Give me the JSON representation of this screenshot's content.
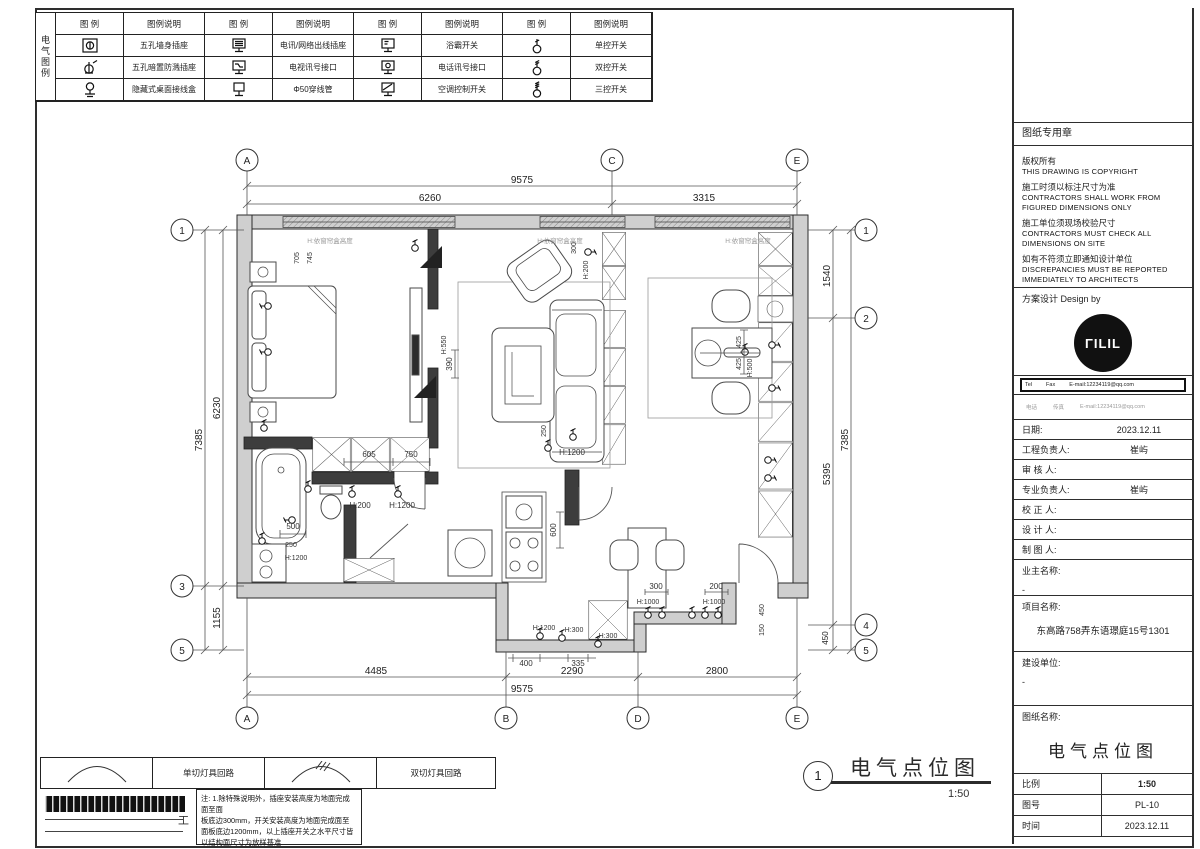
{
  "legend": {
    "side_label": "电气图例",
    "header_icon": "图 例",
    "header_desc": "图例说明",
    "groups": [
      {
        "rows": [
          {
            "icon": "five-hole-wall-socket-icon",
            "label": "五孔墙身插座"
          },
          {
            "icon": "five-hole-splash-proof-socket-icon",
            "label": "五孔暗置防溅插座"
          },
          {
            "icon": "concealed-desktop-junction-box-icon",
            "label": "隐藏式桌面接线盒"
          }
        ]
      },
      {
        "rows": [
          {
            "icon": "telecom-network-outlet-icon",
            "label": "电讯/网络出线插座"
          },
          {
            "icon": "tv-signal-outlet-icon",
            "label": "电视讯号接口"
          },
          {
            "icon": "conduit-icon",
            "label": "Φ50穿线管"
          }
        ]
      },
      {
        "rows": [
          {
            "icon": "bath-heater-switch-icon",
            "label": "浴霸开关"
          },
          {
            "icon": "phone-signal-outlet-icon",
            "label": "电话讯号接口"
          },
          {
            "icon": "ac-control-switch-icon",
            "label": "空调控制开关"
          }
        ]
      },
      {
        "rows": [
          {
            "icon": "single-switch-icon",
            "label": "单控开关"
          },
          {
            "icon": "double-switch-icon",
            "label": "双控开关"
          },
          {
            "icon": "triple-switch-icon",
            "label": "三控开关"
          }
        ]
      }
    ]
  },
  "titleblock": {
    "stamp_title": "图纸专用章",
    "copyright_lines": [
      {
        "t": "版权所有"
      },
      {
        "t": "THIS DRAWING IS COPYRIGHT"
      },
      {
        "t": "施工时须以标注尺寸为准"
      },
      {
        "t": "CONTRACTORS SHALL WORK FROM"
      },
      {
        "t": "FIGURED DIMENSIONS ONLY"
      },
      {
        "t": "施工单位须现场校验尺寸"
      },
      {
        "t": "CONTRACTORS MUST CHECK ALL"
      },
      {
        "t": "DIMENSIONS ON SITE"
      },
      {
        "t": "如有不符须立即通知设计单位"
      },
      {
        "t": "DISCREPANCIES MUST BE REPORTED"
      },
      {
        "t": "IMMEDIATELY TO ARCHITECTS"
      }
    ],
    "design_by": "方案设计 Design by",
    "logo_text": "ΓILIL",
    "contact": {
      "tel": "Tel",
      "fax": "Fax",
      "email": "E-mail:12234119@qq.com"
    },
    "contact2": {
      "tel": "电话",
      "fax": "传真",
      "email": "E-mail:12234119@qq.com"
    },
    "fields": [
      {
        "label": "日期:",
        "value": "2023.12.11"
      },
      {
        "label": "工程负责人:",
        "value": "崔屿"
      },
      {
        "label": "审 核 人:",
        "value": ""
      },
      {
        "label": "专业负责人:",
        "value": "崔屿"
      },
      {
        "label": "校 正 人:",
        "value": ""
      },
      {
        "label": "设 计 人:",
        "value": ""
      },
      {
        "label": "制 图 人:",
        "value": ""
      }
    ],
    "owner": {
      "label": "业主名称:",
      "value": "-"
    },
    "project": {
      "label": "项目名称:",
      "value": "东高路758弄东语璟庭15号1301"
    },
    "builder": {
      "label": "建设单位:",
      "value": "-"
    },
    "sheet_name": {
      "label": "图纸名称:",
      "value": "电气点位图"
    },
    "meta": [
      {
        "label": "比例",
        "value": "1:50"
      },
      {
        "label": "图号",
        "value": "PL-10"
      },
      {
        "label": "时间",
        "value": "2023.12.11"
      }
    ]
  },
  "footer": {
    "circuit_legend": [
      {
        "icon": "single-circuit-arc-icon",
        "label": "单切灯具回路"
      },
      {
        "icon": "double-circuit-arc-icon",
        "label": "双切灯具回路"
      }
    ],
    "end_mark": "工",
    "note_lines": [
      "注: 1.除特殊说明外，插座安装高度为地面完成面至面",
      "板底边300mm，开关安装高度为地面完成面至",
      "面板底边1200mm，以上插座开关之水平尺寸皆",
      "以结构面尺寸为放样基准"
    ]
  },
  "title": {
    "number": "1",
    "name": "电气点位图",
    "scale": "1:50"
  },
  "plan": {
    "axes_top": [
      "A",
      "C",
      "E"
    ],
    "axes_bottom": [
      "A",
      "B",
      "D",
      "E"
    ],
    "axes_left": [
      "1",
      "3",
      "5"
    ],
    "axes_right": [
      "1",
      "2",
      "4",
      "5"
    ],
    "dims": {
      "top_total": "9575",
      "top_a_c": "6260",
      "top_c_e": "3315",
      "bottom_a_b": "4485",
      "bottom_b_d": "2290",
      "bottom_d_e": "2800",
      "bottom_total": "9575",
      "left_total": "7385",
      "left_1_3": "6230",
      "left_3_5": "1155",
      "right_1_2": "1540",
      "right_2_4": "5395",
      "right_4_5": "450",
      "right_total": "7385"
    },
    "labels": [
      {
        "t": "H:依窗帘盒高度"
      },
      {
        "t": "H:依窗帘盒高度"
      },
      {
        "t": "H:依窗帘盒高度"
      },
      {
        "t": "705"
      },
      {
        "t": "745"
      },
      {
        "t": "300"
      },
      {
        "t": "H:200"
      },
      {
        "t": "H:550"
      },
      {
        "t": "390"
      },
      {
        "t": "250"
      },
      {
        "t": "H:1200"
      },
      {
        "t": "605"
      },
      {
        "t": "750"
      },
      {
        "t": "H:200"
      },
      {
        "t": "H:1200"
      },
      {
        "t": "500"
      },
      {
        "t": "250"
      },
      {
        "t": "H:1200"
      },
      {
        "t": "600"
      },
      {
        "t": "H:1200"
      },
      {
        "t": "H:300"
      },
      {
        "t": "H:300"
      },
      {
        "t": "400"
      },
      {
        "t": "335"
      },
      {
        "t": "300"
      },
      {
        "t": "200"
      },
      {
        "t": "H:1000"
      },
      {
        "t": "H:1000"
      },
      {
        "t": "425"
      },
      {
        "t": "425"
      },
      {
        "t": "H:500"
      },
      {
        "t": "450"
      },
      {
        "t": "150"
      }
    ]
  }
}
